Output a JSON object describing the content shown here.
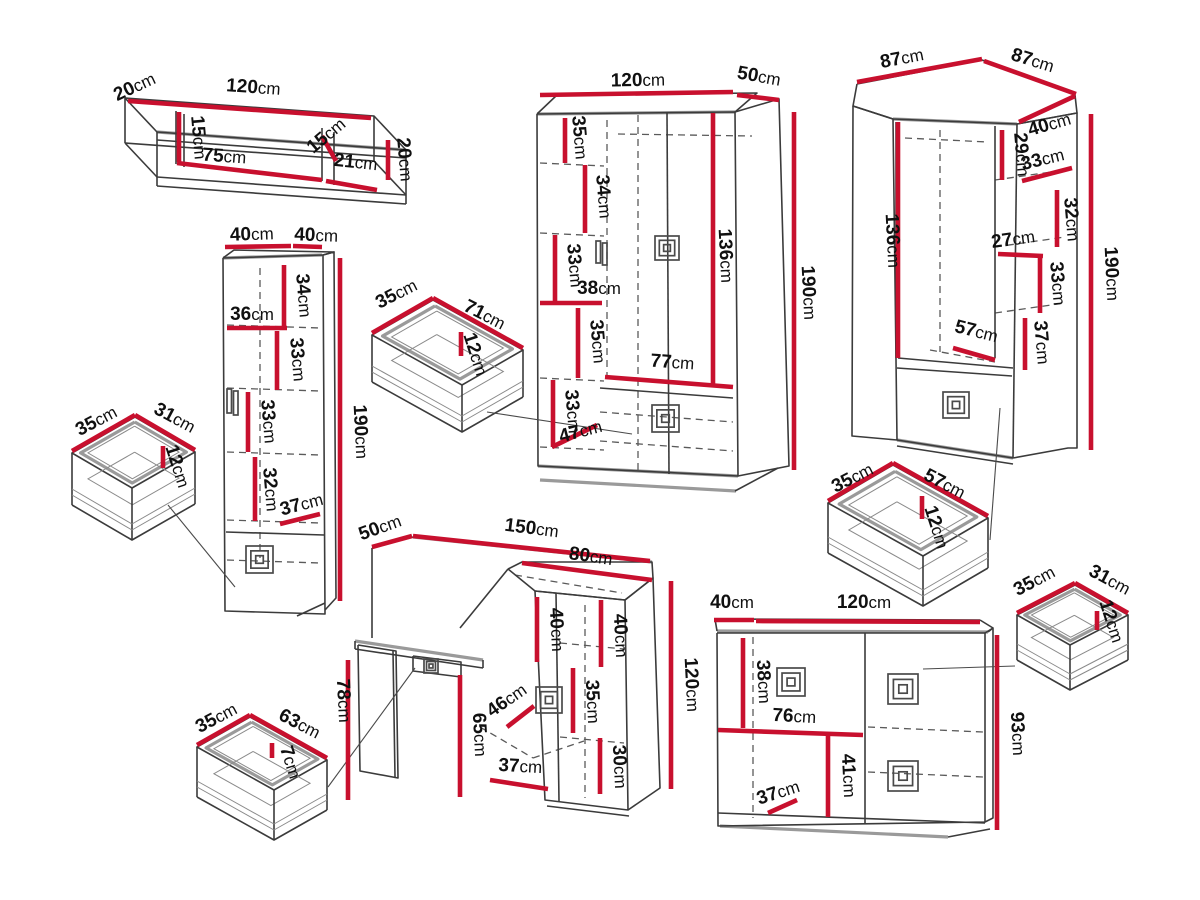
{
  "diagram": {
    "title": "Furniture set dimension diagram",
    "unit": "cm",
    "background_color": "#ffffff",
    "dimension_line_color": "#c8102e",
    "outline_color": "#3b3b3b",
    "pieces": [
      "wall-shelf",
      "tall-cabinet",
      "small-drawer-left",
      "medium-drawer",
      "two-door-wardrobe",
      "corner-wardrobe",
      "wide-drawer-right",
      "small-drawer-right",
      "desk-with-cabinet",
      "drawer-bottom-left",
      "chest-of-drawers"
    ]
  },
  "labels": [
    {
      "piece": "wall-shelf",
      "text": "20cm",
      "x": 137,
      "y": 92,
      "r": -25
    },
    {
      "piece": "wall-shelf",
      "text": "120cm",
      "x": 253,
      "y": 93,
      "r": 4
    },
    {
      "piece": "wall-shelf",
      "text": "15cm",
      "x": 193,
      "y": 138,
      "r": 85
    },
    {
      "piece": "wall-shelf",
      "text": "75cm",
      "x": 224,
      "y": 162,
      "r": 4
    },
    {
      "piece": "wall-shelf",
      "text": "15cm",
      "x": 330,
      "y": 140,
      "r": -40
    },
    {
      "piece": "wall-shelf",
      "text": "21cm",
      "x": 355,
      "y": 168,
      "r": 6
    },
    {
      "piece": "wall-shelf",
      "text": "20cm",
      "x": 399,
      "y": 160,
      "r": 85
    },
    {
      "piece": "tall-cabinet",
      "text": "40cm",
      "x": 252,
      "y": 240,
      "r": -2
    },
    {
      "piece": "tall-cabinet",
      "text": "40cm",
      "x": 316,
      "y": 241,
      "r": 2
    },
    {
      "piece": "tall-cabinet",
      "text": "34cm",
      "x": 298,
      "y": 296,
      "r": 85
    },
    {
      "piece": "tall-cabinet",
      "text": "36cm",
      "x": 252,
      "y": 320,
      "r": 0
    },
    {
      "piece": "tall-cabinet",
      "text": "33cm",
      "x": 292,
      "y": 360,
      "r": 85
    },
    {
      "piece": "tall-cabinet",
      "text": "33cm",
      "x": 263,
      "y": 422,
      "r": 85
    },
    {
      "piece": "tall-cabinet",
      "text": "32cm",
      "x": 265,
      "y": 490,
      "r": 85
    },
    {
      "piece": "tall-cabinet",
      "text": "37cm",
      "x": 303,
      "y": 510,
      "r": -15
    },
    {
      "piece": "tall-cabinet",
      "text": "190cm",
      "x": 355,
      "y": 432,
      "r": 87
    },
    {
      "piece": "small-drawer-left",
      "text": "35cm",
      "x": 99,
      "y": 426,
      "r": -28
    },
    {
      "piece": "small-drawer-left",
      "text": "31cm",
      "x": 172,
      "y": 423,
      "r": 28
    },
    {
      "piece": "small-drawer-left",
      "text": "12cm",
      "x": 172,
      "y": 468,
      "r": 72
    },
    {
      "piece": "medium-drawer",
      "text": "35cm",
      "x": 399,
      "y": 299,
      "r": -27
    },
    {
      "piece": "medium-drawer",
      "text": "71cm",
      "x": 482,
      "y": 320,
      "r": 27
    },
    {
      "piece": "medium-drawer",
      "text": "12cm",
      "x": 470,
      "y": 356,
      "r": 72
    },
    {
      "piece": "two-door-wardrobe",
      "text": "120cm",
      "x": 638,
      "y": 86,
      "r": -1
    },
    {
      "piece": "two-door-wardrobe",
      "text": "50cm",
      "x": 758,
      "y": 82,
      "r": 10
    },
    {
      "piece": "two-door-wardrobe",
      "text": "35cm",
      "x": 574,
      "y": 138,
      "r": 85
    },
    {
      "piece": "two-door-wardrobe",
      "text": "34cm",
      "x": 598,
      "y": 197,
      "r": 85
    },
    {
      "piece": "two-door-wardrobe",
      "text": "33cm",
      "x": 569,
      "y": 266,
      "r": 85
    },
    {
      "piece": "two-door-wardrobe",
      "text": "38cm",
      "x": 599,
      "y": 294,
      "r": 0
    },
    {
      "piece": "two-door-wardrobe",
      "text": "35cm",
      "x": 592,
      "y": 342,
      "r": 85
    },
    {
      "piece": "two-door-wardrobe",
      "text": "33cm",
      "x": 567,
      "y": 412,
      "r": 85
    },
    {
      "piece": "two-door-wardrobe",
      "text": "47cm",
      "x": 582,
      "y": 437,
      "r": -15
    },
    {
      "piece": "two-door-wardrobe",
      "text": "77cm",
      "x": 672,
      "y": 368,
      "r": 4
    },
    {
      "piece": "two-door-wardrobe",
      "text": "136cm",
      "x": 720,
      "y": 256,
      "r": 87
    },
    {
      "piece": "two-door-wardrobe",
      "text": "190cm",
      "x": 803,
      "y": 293,
      "r": 87
    },
    {
      "piece": "corner-wardrobe",
      "text": "87cm",
      "x": 903,
      "y": 64,
      "r": -11
    },
    {
      "piece": "corner-wardrobe",
      "text": "87cm",
      "x": 1031,
      "y": 66,
      "r": 17
    },
    {
      "piece": "corner-wardrobe",
      "text": "40cm",
      "x": 1051,
      "y": 130,
      "r": -16
    },
    {
      "piece": "corner-wardrobe",
      "text": "29cm",
      "x": 1016,
      "y": 155,
      "r": 85
    },
    {
      "piece": "corner-wardrobe",
      "text": "33cm",
      "x": 1044,
      "y": 165,
      "r": -14
    },
    {
      "piece": "corner-wardrobe",
      "text": "32cm",
      "x": 1066,
      "y": 220,
      "r": 85
    },
    {
      "piece": "corner-wardrobe",
      "text": "27cm",
      "x": 1014,
      "y": 245,
      "r": -8
    },
    {
      "piece": "corner-wardrobe",
      "text": "33cm",
      "x": 1052,
      "y": 284,
      "r": 85
    },
    {
      "piece": "corner-wardrobe",
      "text": "37cm",
      "x": 1036,
      "y": 343,
      "r": 85
    },
    {
      "piece": "corner-wardrobe",
      "text": "57cm",
      "x": 975,
      "y": 337,
      "r": 14
    },
    {
      "piece": "corner-wardrobe",
      "text": "136cm",
      "x": 887,
      "y": 241,
      "r": 87
    },
    {
      "piece": "corner-wardrobe",
      "text": "190cm",
      "x": 1106,
      "y": 274,
      "r": 87
    },
    {
      "piece": "wide-drawer-right",
      "text": "35cm",
      "x": 855,
      "y": 483,
      "r": -27
    },
    {
      "piece": "wide-drawer-right",
      "text": "57cm",
      "x": 942,
      "y": 489,
      "r": 27
    },
    {
      "piece": "wide-drawer-right",
      "text": "12cm",
      "x": 931,
      "y": 529,
      "r": 72
    },
    {
      "piece": "small-drawer-right",
      "text": "35cm",
      "x": 1037,
      "y": 586,
      "r": -28
    },
    {
      "piece": "small-drawer-right",
      "text": "31cm",
      "x": 1107,
      "y": 585,
      "r": 28
    },
    {
      "piece": "small-drawer-right",
      "text": "12cm",
      "x": 1106,
      "y": 623,
      "r": 72
    },
    {
      "piece": "desk-with-cabinet",
      "text": "50cm",
      "x": 382,
      "y": 533,
      "r": -20
    },
    {
      "piece": "desk-with-cabinet",
      "text": "150cm",
      "x": 531,
      "y": 534,
      "r": 7
    },
    {
      "piece": "desk-with-cabinet",
      "text": "80cm",
      "x": 590,
      "y": 562,
      "r": 8
    },
    {
      "piece": "desk-with-cabinet",
      "text": "40cm",
      "x": 551,
      "y": 630,
      "r": 87
    },
    {
      "piece": "desk-with-cabinet",
      "text": "40cm",
      "x": 615,
      "y": 636,
      "r": 87
    },
    {
      "piece": "desk-with-cabinet",
      "text": "35cm",
      "x": 587,
      "y": 702,
      "r": 87
    },
    {
      "piece": "desk-with-cabinet",
      "text": "30cm",
      "x": 614,
      "y": 767,
      "r": 87
    },
    {
      "piece": "desk-with-cabinet",
      "text": "120cm",
      "x": 686,
      "y": 685,
      "r": 87
    },
    {
      "piece": "desk-with-cabinet",
      "text": "46cm",
      "x": 510,
      "y": 705,
      "r": -35
    },
    {
      "piece": "desk-with-cabinet",
      "text": "65cm",
      "x": 474,
      "y": 735,
      "r": 87
    },
    {
      "piece": "desk-with-cabinet",
      "text": "37cm",
      "x": 520,
      "y": 772,
      "r": 3
    },
    {
      "piece": "desk-with-cabinet",
      "text": "78cm",
      "x": 338,
      "y": 701,
      "r": 87
    },
    {
      "piece": "drawer-bottom-left",
      "text": "35cm",
      "x": 219,
      "y": 723,
      "r": -28
    },
    {
      "piece": "drawer-bottom-left",
      "text": "63cm",
      "x": 297,
      "y": 729,
      "r": 27
    },
    {
      "piece": "drawer-bottom-left",
      "text": "7cm",
      "x": 285,
      "y": 764,
      "r": 72
    },
    {
      "piece": "chest-of-drawers",
      "text": "40cm",
      "x": 732,
      "y": 608,
      "r": 0
    },
    {
      "piece": "chest-of-drawers",
      "text": "120cm",
      "x": 864,
      "y": 608,
      "r": 0
    },
    {
      "piece": "chest-of-drawers",
      "text": "38cm",
      "x": 758,
      "y": 682,
      "r": 87
    },
    {
      "piece": "chest-of-drawers",
      "text": "76cm",
      "x": 794,
      "y": 722,
      "r": 3
    },
    {
      "piece": "chest-of-drawers",
      "text": "41cm",
      "x": 843,
      "y": 776,
      "r": 87
    },
    {
      "piece": "chest-of-drawers",
      "text": "37cm",
      "x": 780,
      "y": 798,
      "r": -18
    },
    {
      "piece": "chest-of-drawers",
      "text": "93cm",
      "x": 1012,
      "y": 734,
      "r": 87
    }
  ]
}
